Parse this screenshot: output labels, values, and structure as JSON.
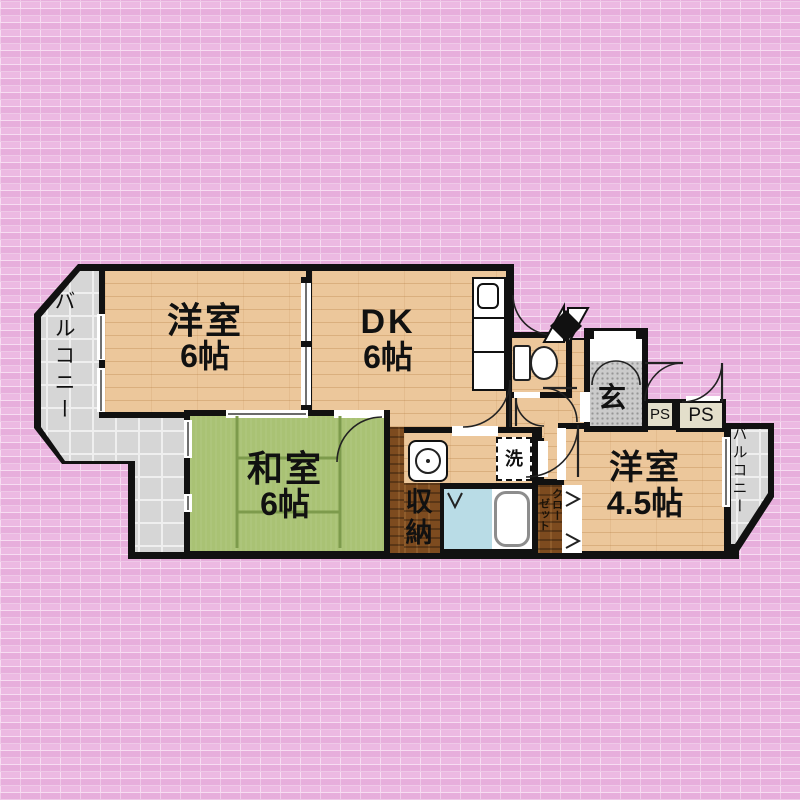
{
  "plan": {
    "type": "apartment-floor-plan",
    "rooms": {
      "western_6": {
        "label": "洋室",
        "size": "6帖"
      },
      "dk": {
        "label": "DK",
        "size": "6帖"
      },
      "japanese_6": {
        "label": "和室",
        "size": "6帖"
      },
      "western_45": {
        "label": "洋室",
        "size": "4.5帖"
      },
      "entrance": {
        "label": "玄"
      },
      "storage": {
        "label": "収納"
      },
      "closet": {
        "col_right": "クロー",
        "col_left": "ゼット"
      },
      "laundry": {
        "label": "洗"
      },
      "balcony_left": {
        "label": "バルコニー"
      },
      "balcony_right": {
        "label": "バルコニー"
      },
      "ps_left": {
        "label": "PS"
      },
      "ps_right": {
        "label": "PS"
      }
    },
    "colors": {
      "background_brick": "#ecb9e2",
      "wood_floor": "#ecc79b",
      "tatami_green": "#a9c274",
      "dark_wood": "#7d4b1f",
      "balcony_tile": "#d6d6d6",
      "entrance_floor": "#cbcbcb",
      "bath_floor": "#b9dce6",
      "wall": "#111111",
      "ps_fill": "#e3dfcb"
    },
    "fixtures": [
      "kitchen-counter",
      "toilet",
      "washbasin",
      "washing-machine",
      "bathtub"
    ]
  }
}
